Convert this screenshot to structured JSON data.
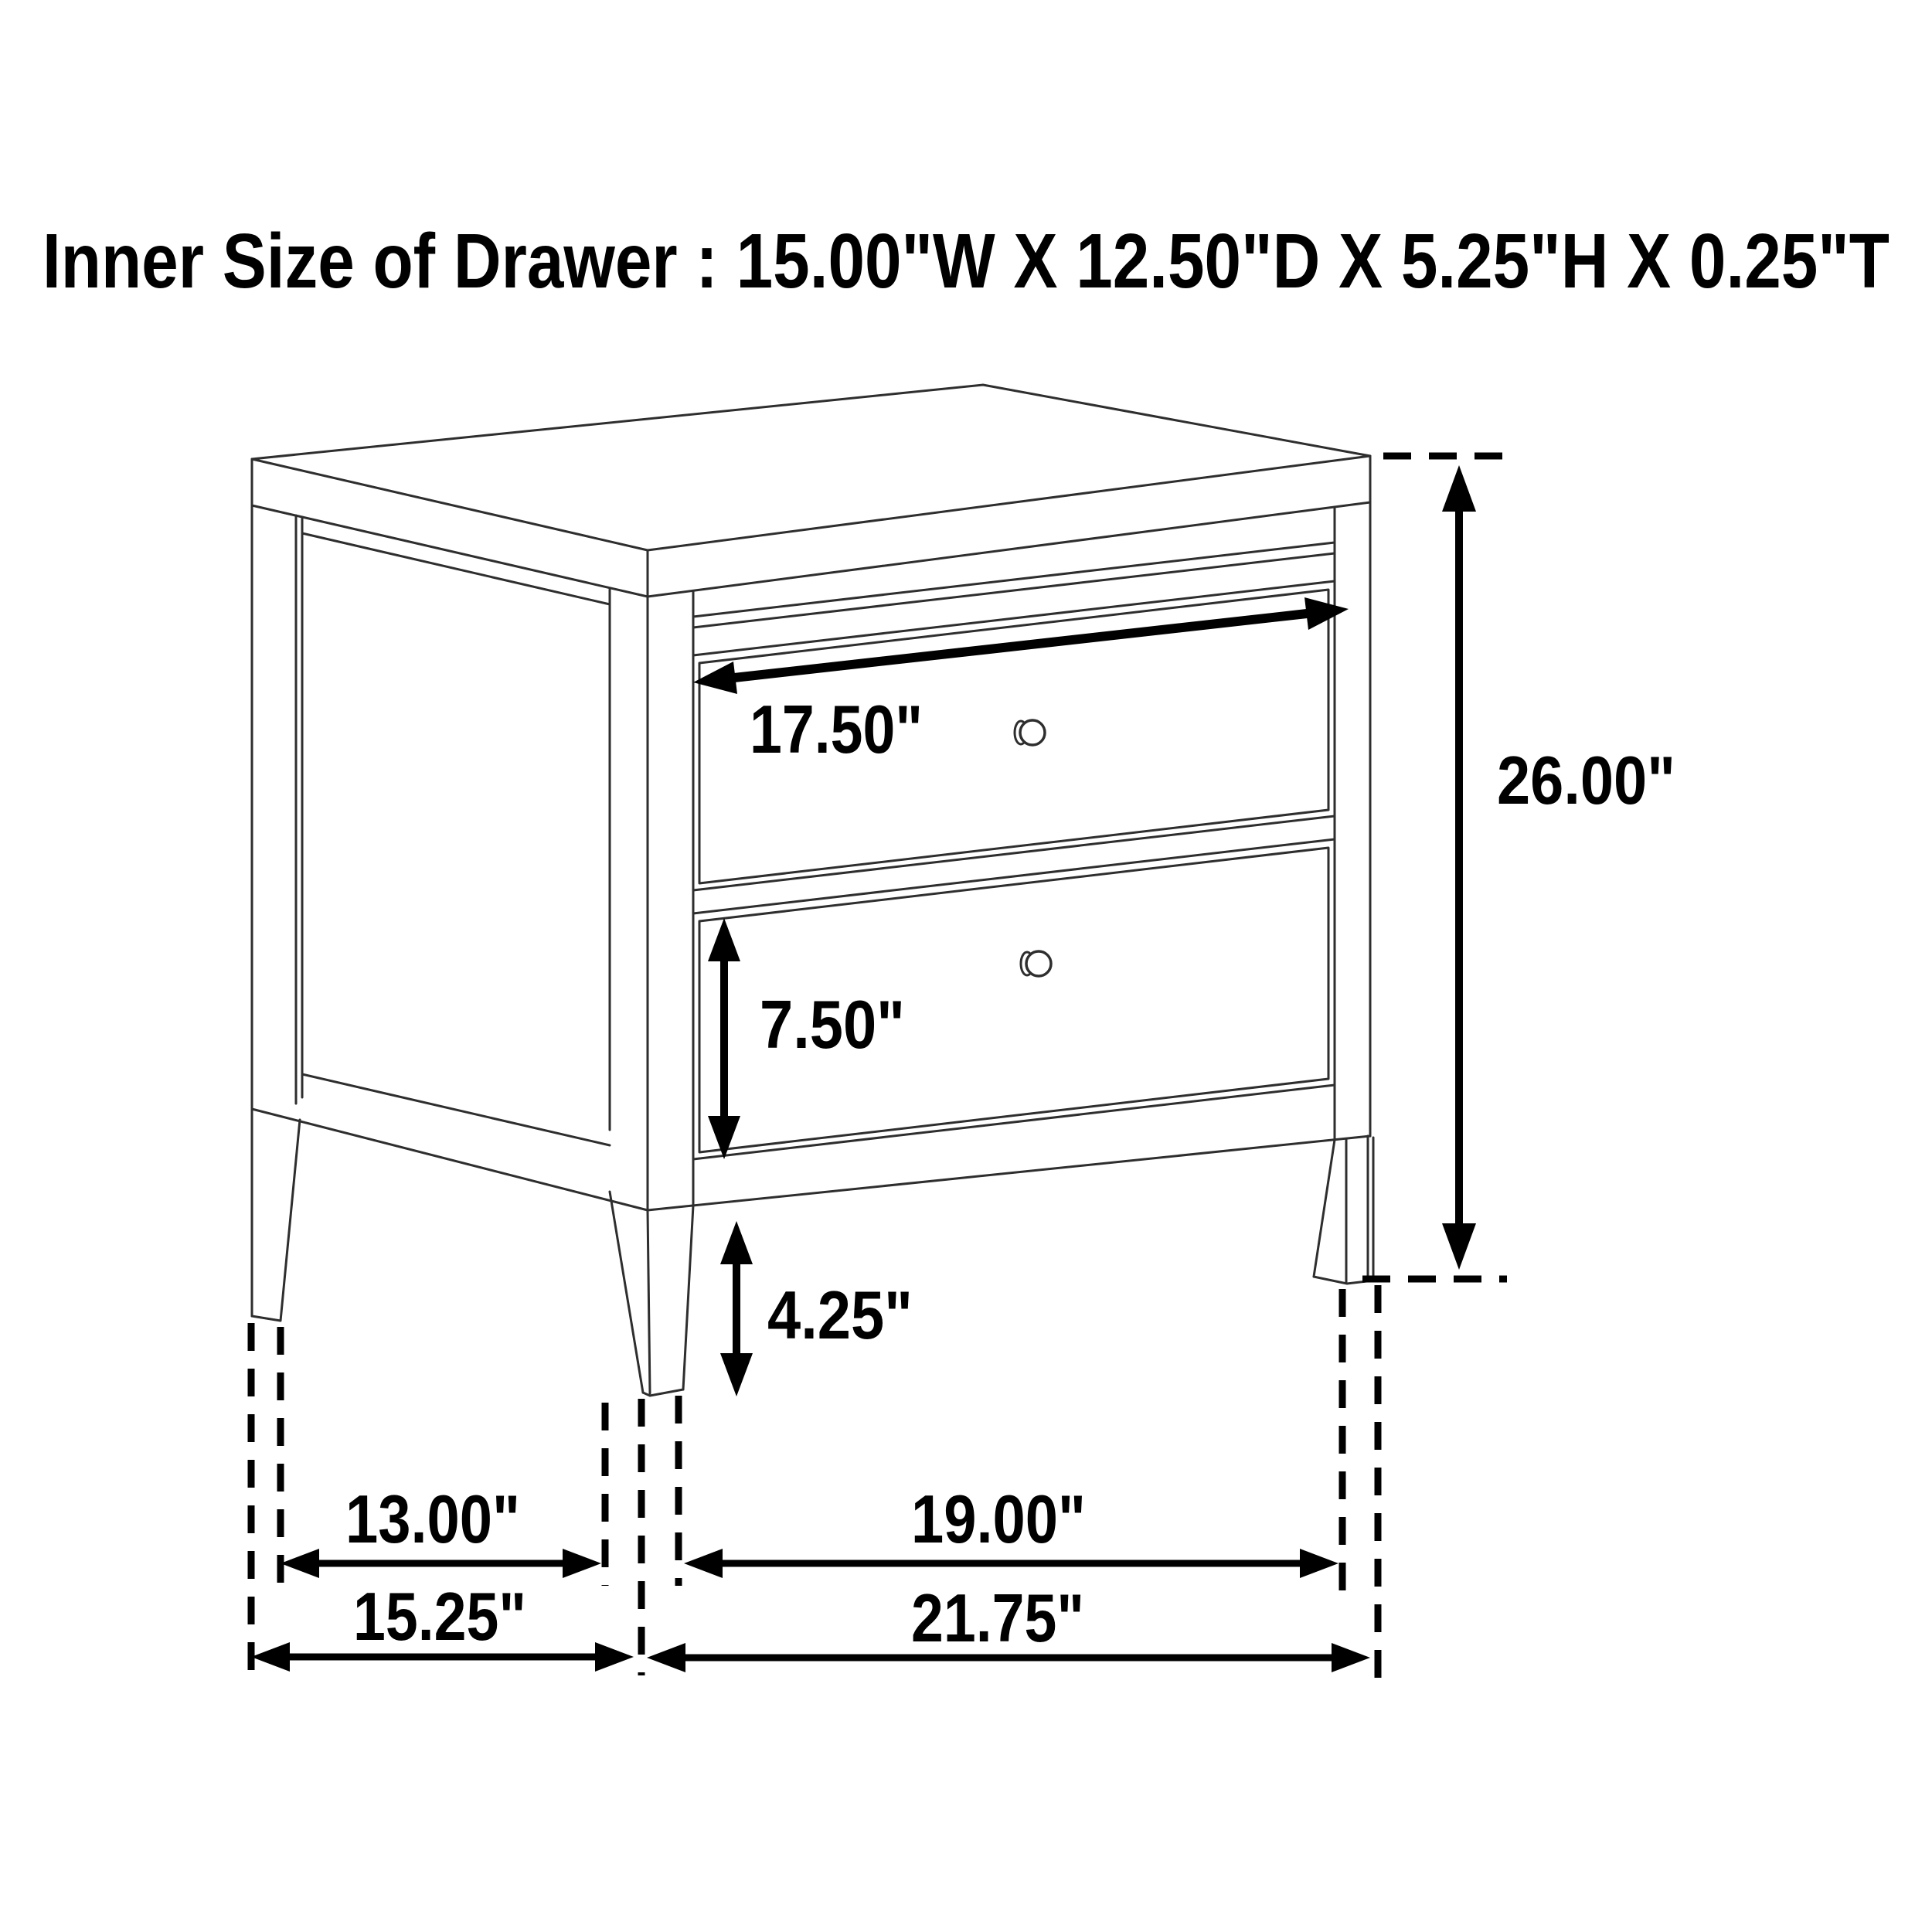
{
  "page": {
    "background_color": "#ffffff",
    "drawing_line_color": "#2e2e2e",
    "annotation_color": "#000000"
  },
  "title": "Inner Size of Drawer : 15.00\"W X 12.50\"D X 5.25\"H X 0.25\"T",
  "inner_drawer_size": {
    "width": "15.00\"W",
    "depth": "12.50\"D",
    "height": "5.25\"H",
    "thickness": "0.25\"T"
  },
  "diagram": {
    "type": "furniture-dimension-line-drawing",
    "subject": "two-drawer nightstand with round knobs and tapered legs",
    "drawer_count": 2,
    "dimensions": {
      "drawer_front_width": "17.50\"",
      "lower_drawer_front_height": "7.50\"",
      "leg_clearance_height": "4.25\"",
      "overall_height": "26.00\"",
      "side_inner_leg_span": "13.00\"",
      "front_inner_leg_span": "19.00\"",
      "overall_depth": "15.25\"",
      "overall_width": "21.75\""
    }
  }
}
